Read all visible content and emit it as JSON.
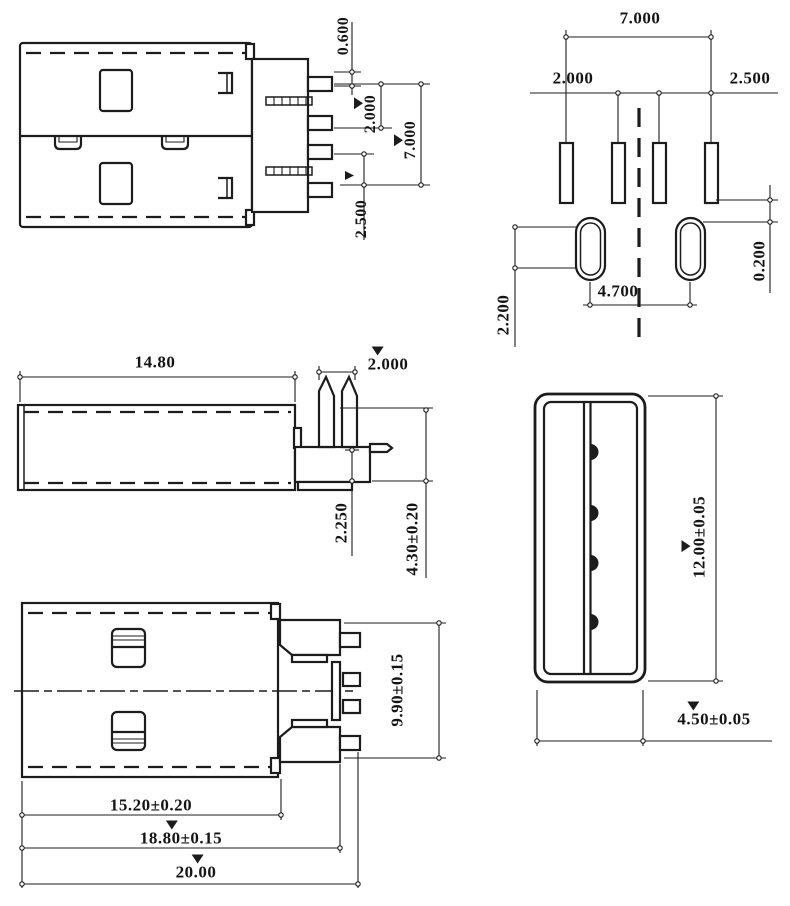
{
  "drawing": {
    "background": "#ffffff",
    "line_color": "#1c1c1c",
    "dims": {
      "plug_side": {
        "d1": "0.600",
        "d2": "2.000",
        "d3": "7.000",
        "d4": "2.500"
      },
      "footprint": {
        "d1": "7.000",
        "d2": "2.000",
        "d3": "2.500",
        "d4": "0.200",
        "d5": "4.700",
        "d6": "2.200"
      },
      "shell_side": {
        "d1": "14.80",
        "d2": "2.000",
        "d3": "2.250",
        "d4": "4.30±0.20"
      },
      "plug_top": {
        "d1": "9.90±0.15",
        "d2": "15.20±0.20",
        "d3": "18.80±0.15",
        "d4": "20.00"
      },
      "front": {
        "d1": "12.00±0.05",
        "d2": "4.50±0.05"
      }
    }
  }
}
